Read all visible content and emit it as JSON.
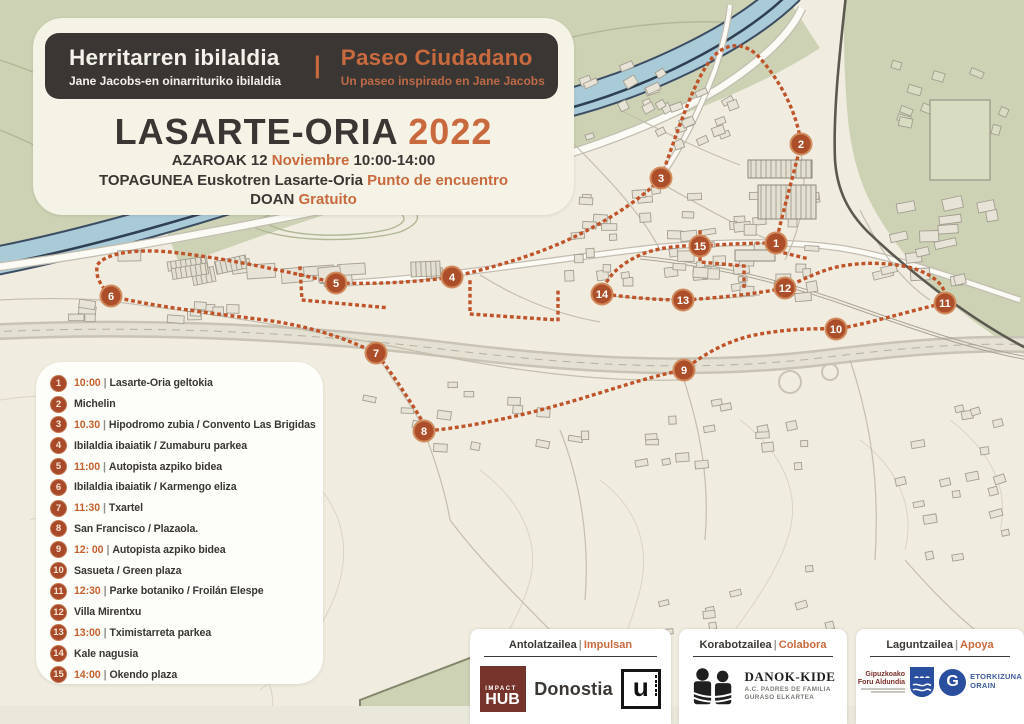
{
  "poster": {
    "title_eu": "Herritarren ibilaldia",
    "subtitle_eu": "Jane Jacobs-en oinarrituriko ibilaldia",
    "divider": "|",
    "title_es": "Paseo Ciudadano",
    "subtitle_es": "Un paseo inspirado en Jane Jacobs",
    "city": "LASARTE-ORIA",
    "year": "2022",
    "date_eu": "AZAROAK 12",
    "date_es": "Noviembre",
    "hours": "10:00-14:00",
    "meeting_eu": "TOPAGUNEA Euskotren Lasarte-Oria",
    "meeting_es": "Punto de encuentro",
    "free_eu": "DOAN",
    "free_es": "Gratuito"
  },
  "legend": {
    "items": [
      {
        "n": "1",
        "time": "10:00",
        "sep": "|",
        "name": "Lasarte-Oria geltokia"
      },
      {
        "n": "2",
        "time": "",
        "sep": "",
        "name": "Michelin"
      },
      {
        "n": "3",
        "time": "10.30",
        "sep": "|",
        "name": "Hipodromo zubia / Convento Las Brigidas"
      },
      {
        "n": "4",
        "time": "",
        "sep": "",
        "name": "Ibilaldia ibaiatik / Zumaburu parkea"
      },
      {
        "n": "5",
        "time": "11:00",
        "sep": "|",
        "name": "Autopista azpiko bidea"
      },
      {
        "n": "6",
        "time": "",
        "sep": "",
        "name": "Ibilaldia ibaiatik / Karmengo eliza"
      },
      {
        "n": "7",
        "time": "11:30",
        "sep": "|",
        "name": "Txartel"
      },
      {
        "n": "8",
        "time": "",
        "sep": "",
        "name": "San Francisco / Plazaola."
      },
      {
        "n": "9",
        "time": "12: 00",
        "sep": "|",
        "name": "Autopista azpiko bidea"
      },
      {
        "n": "10",
        "time": "",
        "sep": "",
        "name": "Sasueta / Green plaza"
      },
      {
        "n": "11",
        "time": "12:30",
        "sep": "|",
        "name": "Parke botaniko / Froilán Elespe"
      },
      {
        "n": "12",
        "time": "",
        "sep": "",
        "name": "Villa Mirentxu"
      },
      {
        "n": "13",
        "time": "13:00",
        "sep": "|",
        "name": "Tximistarreta parkea"
      },
      {
        "n": "14",
        "time": "",
        "sep": "",
        "name": "Kale nagusia"
      },
      {
        "n": "15",
        "time": "14:00",
        "sep": "|",
        "name": "Okendo plaza"
      }
    ]
  },
  "map": {
    "markers": [
      {
        "n": "1",
        "x": 776,
        "y": 243
      },
      {
        "n": "2",
        "x": 801,
        "y": 144
      },
      {
        "n": "3",
        "x": 661,
        "y": 178
      },
      {
        "n": "4",
        "x": 452,
        "y": 277
      },
      {
        "n": "5",
        "x": 336,
        "y": 283
      },
      {
        "n": "6",
        "x": 111,
        "y": 296
      },
      {
        "n": "7",
        "x": 376,
        "y": 353
      },
      {
        "n": "8",
        "x": 424,
        "y": 431
      },
      {
        "n": "9",
        "x": 684,
        "y": 370
      },
      {
        "n": "10",
        "x": 836,
        "y": 329
      },
      {
        "n": "11",
        "x": 945,
        "y": 303
      },
      {
        "n": "12",
        "x": 785,
        "y": 288
      },
      {
        "n": "13",
        "x": 683,
        "y": 300
      },
      {
        "n": "14",
        "x": 602,
        "y": 294
      },
      {
        "n": "15",
        "x": 700,
        "y": 246
      }
    ]
  },
  "footer": {
    "sections": [
      {
        "title_eu": "Antolatzailea",
        "sep": "|",
        "title_es": "Impulsan"
      },
      {
        "title_eu": "Korabotzailea",
        "sep": "|",
        "title_es": "Colabora"
      },
      {
        "title_eu": "Laguntzailea",
        "sep": "|",
        "title_es": "Apoya"
      }
    ],
    "logos": {
      "impact_hub": {
        "top": "IMPACT",
        "main": "HUB",
        "name": "Donostia"
      },
      "u": {
        "letter": "u"
      },
      "danok_kide": {
        "name": "DANOK-KIDE",
        "sub1": "A.C. PADRES DE FAMILIA",
        "sub2": "GURASO ELKARTEA"
      },
      "gipuzkoa": {
        "line1": "Gipuzkoako",
        "line2": "Foru Aldundia"
      },
      "etorkizuna": {
        "letter": "G",
        "line1": "ETORKIZUNA",
        "line2": "ORAIN"
      }
    }
  },
  "colors": {
    "accent": "#c96a3e",
    "dark": "#3a3633",
    "route": "#bf532a",
    "marker": "#a8492a",
    "river": "#a9cbd8",
    "green": "#cdd2b4"
  }
}
